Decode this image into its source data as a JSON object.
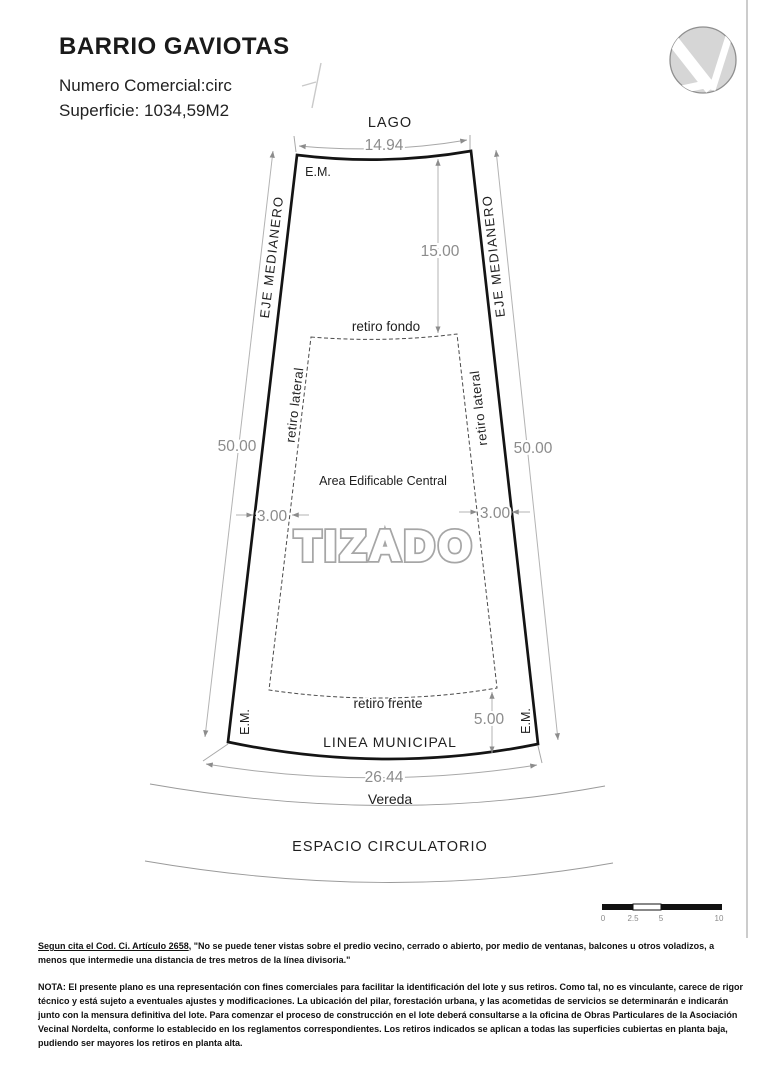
{
  "header": {
    "title": "BARRIO GAVIOTAS",
    "numero_comercial": "Numero Comercial:circ",
    "superficie": "Superficie: 1034,59M2"
  },
  "plan": {
    "lago_label": "LAGO",
    "front_top_dim": "14.94",
    "em_top": "E.M.",
    "eje_medianero": "EJE MEDIANERO",
    "retiro_fondo_label": "retiro fondo",
    "retiro_fondo_dim": "15.00",
    "retiro_lateral_label": "retiro lateral",
    "retiro_lateral_dim": "3.00",
    "side_dim": "50.00",
    "area_edificable_label": "Area Edificable Central",
    "watermark": "TIZADO",
    "retiro_frente_label": "retiro frente",
    "retiro_frente_dim": "5.00",
    "em_bottom": "E.M.",
    "linea_municipal_label": "LINEA MUNICIPAL",
    "front_bottom_dim": "26.44",
    "vereda_label": "Vereda",
    "espacio_circulatorio_label": "ESPACIO CIRCULATORIO",
    "scale_bar": {
      "ticks": [
        "0",
        "2.5",
        "5",
        "10"
      ]
    }
  },
  "footer": {
    "cita_lead": "Segun cita el Cod. Ci. Artículo 2658",
    "cita_text": ", \"No se puede tener vistas sobre el predio vecino, cerrado o abierto, por medio de ventanas, balcones u otros voladizos, a menos que intermedie una distancia de tres metros de la línea divisoria.\"",
    "nota_lead": "NOTA:",
    "nota_text": " El presente plano es una representación con fines comerciales para facilitar la identificación del lote y sus retiros. Como tal, no es vinculante, carece de rigor técnico y está sujeto a eventuales ajustes y modificaciones. La ubicación del pilar, forestación urbana, y las acometidas de servicios se determinarán e indicarán junto con la mensura definitiva del lote. Para comenzar el proceso de construcción en el lote deberá consultarse a la oficina de Obras Particulares de la Asociación Vecinal Nordelta, conforme lo establecido en los reglamentos correspondientes. Los retiros indicados se aplican a todas las superficies cubiertas en planta baja, pudiendo ser mayores los retiros en planta alta."
  },
  "colors": {
    "dim_gray": "#8c8c8c",
    "line_black": "#1a1a1a",
    "logo_gray": "#d6d6d6",
    "watermark_gray": "#a6a6a6"
  }
}
